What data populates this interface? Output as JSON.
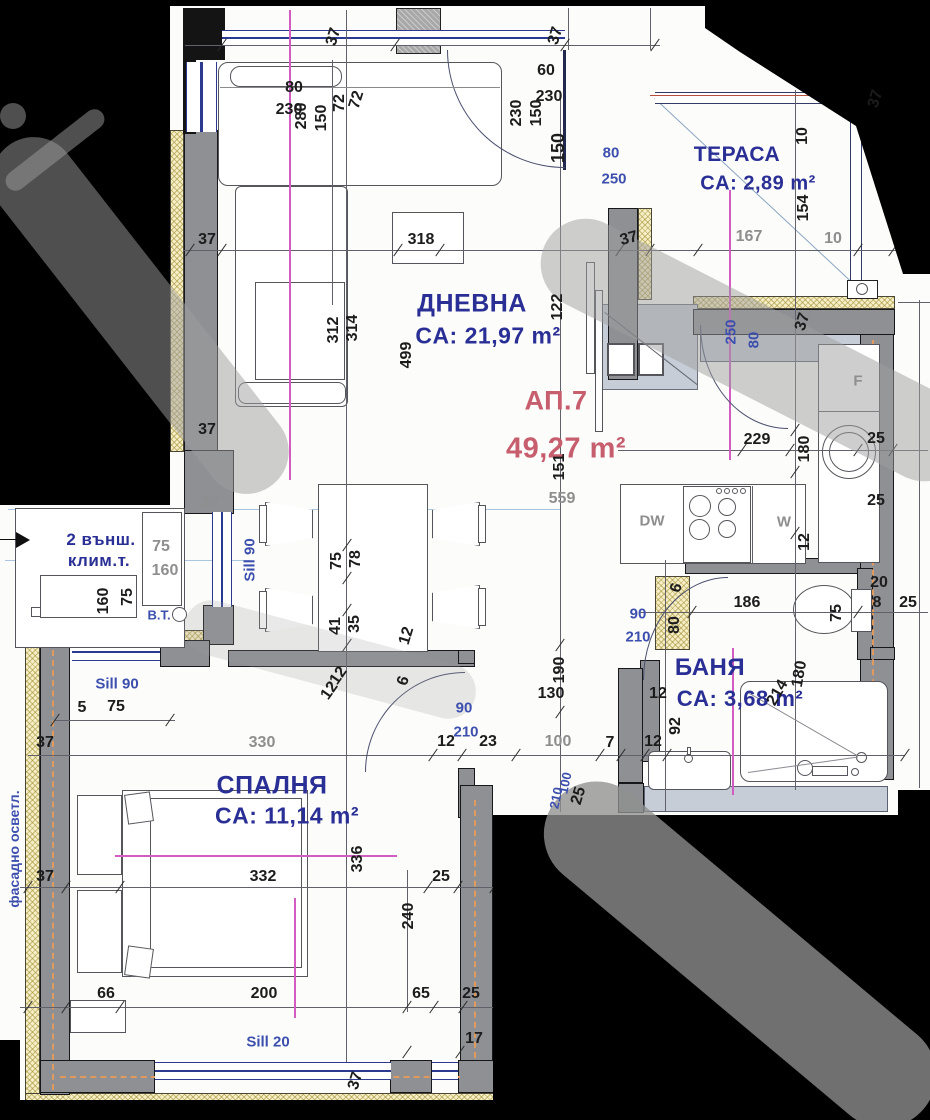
{
  "apartment": {
    "number": "АП.7",
    "area": "49,27 m²"
  },
  "rooms": {
    "living": {
      "name": "ДНЕВНА",
      "area": "CA: 21,97 m²"
    },
    "terrace": {
      "name": "ТЕРАСА",
      "area": "CA: 2,89 m²"
    },
    "bedroom": {
      "name": "СПАЛНЯ",
      "area": "CA: 11,14 m²"
    },
    "bath": {
      "name": "БАНЯ",
      "area": "CA: 3,68 m²"
    }
  },
  "notes": {
    "ac_line1": "2 външ.",
    "ac_line2": "клим.т.",
    "bt": "B.T.",
    "facade": "фасадно осветл.",
    "sill90_vert": "Sill 90",
    "sill90_horiz": "Sill 90",
    "sill20": "Sill 20"
  },
  "appliances": {
    "dishwasher": "DW",
    "washer": "W",
    "fridge": "F"
  },
  "colors": {
    "label_blue": "#2a2f96",
    "dim_dark": "#1c1c1c",
    "dim_gray": "#8e8e8e",
    "dim_blue": "#3c4fae",
    "apartment_red": "#c75e6e",
    "wall_gray": "#8e9094",
    "insulation_yellow": "#f6efc6",
    "centerline_magenta": "#d35cc2",
    "service_orange": "#e09a5e"
  },
  "dims": [
    {
      "t": "37",
      "x": 334,
      "y": 37,
      "r": -73
    },
    {
      "t": "37",
      "x": 556,
      "y": 36,
      "r": -73
    },
    {
      "t": "80",
      "x": 294,
      "y": 88
    },
    {
      "t": "230",
      "x": 289,
      "y": 110
    },
    {
      "t": "280",
      "x": 302,
      "y": 116,
      "r": -90
    },
    {
      "t": "150",
      "x": 322,
      "y": 118,
      "r": -90
    },
    {
      "t": "72",
      "x": 340,
      "y": 103,
      "r": -90
    },
    {
      "t": "72",
      "x": 357,
      "y": 100,
      "r": -73
    },
    {
      "t": "60",
      "x": 546,
      "y": 71
    },
    {
      "t": "230",
      "x": 549,
      "y": 97
    },
    {
      "t": "230",
      "x": 517,
      "y": 113,
      "r": -90
    },
    {
      "t": "150",
      "x": 537,
      "y": 113,
      "r": -90
    },
    {
      "t": "150",
      "x": 558,
      "y": 148,
      "r": -90,
      "fs": 18
    },
    {
      "t": "37",
      "x": 876,
      "y": 99,
      "r": -73
    },
    {
      "t": "10",
      "x": 803,
      "y": 136,
      "r": -90
    },
    {
      "t": "154",
      "x": 804,
      "y": 208,
      "r": -90
    },
    {
      "t": "80",
      "x": 611,
      "y": 153,
      "c": "b"
    },
    {
      "t": "250",
      "x": 614,
      "y": 179,
      "c": "b"
    },
    {
      "t": "167",
      "x": 749,
      "y": 237,
      "c": "g"
    },
    {
      "t": "10",
      "x": 833,
      "y": 239,
      "c": "g"
    },
    {
      "t": "37",
      "x": 629,
      "y": 239,
      "r": -15
    },
    {
      "t": "318",
      "x": 421,
      "y": 240
    },
    {
      "t": "37",
      "x": 207,
      "y": 240
    },
    {
      "t": "314",
      "x": 353,
      "y": 328,
      "r": -90
    },
    {
      "t": "312",
      "x": 334,
      "y": 330,
      "r": -90
    },
    {
      "t": "499",
      "x": 407,
      "y": 355,
      "r": -90
    },
    {
      "t": "122",
      "x": 558,
      "y": 307,
      "r": -90
    },
    {
      "t": "37",
      "x": 207,
      "y": 430
    },
    {
      "t": "37",
      "x": 803,
      "y": 322,
      "r": -73
    },
    {
      "t": "250",
      "x": 731,
      "y": 332,
      "r": -90,
      "c": "b"
    },
    {
      "t": "80",
      "x": 754,
      "y": 340,
      "r": -90,
      "c": "b"
    },
    {
      "t": "229",
      "x": 757,
      "y": 440
    },
    {
      "t": "180",
      "x": 805,
      "y": 449,
      "r": -90
    },
    {
      "t": "25",
      "x": 876,
      "y": 439
    },
    {
      "t": "25",
      "x": 876,
      "y": 501
    },
    {
      "t": "151",
      "x": 560,
      "y": 467,
      "r": -90
    },
    {
      "t": "559",
      "x": 562,
      "y": 499,
      "c": "g"
    },
    {
      "t": "12",
      "x": 805,
      "y": 542,
      "r": -90
    },
    {
      "t": "37",
      "x": 210,
      "y": 503,
      "c": "g"
    },
    {
      "t": "75",
      "x": 161,
      "y": 547,
      "c": "g"
    },
    {
      "t": "160",
      "x": 165,
      "y": 571,
      "c": "g"
    },
    {
      "t": "75",
      "x": 128,
      "y": 597,
      "r": -90
    },
    {
      "t": "160",
      "x": 104,
      "y": 601,
      "r": -90
    },
    {
      "t": "B.T.",
      "x": 159,
      "y": 615,
      "c": "b",
      "fs": 13
    },
    {
      "t": "Sill 90",
      "x": 250,
      "y": 560,
      "r": -90,
      "c": "b"
    },
    {
      "t": "78",
      "x": 356,
      "y": 559,
      "r": -90
    },
    {
      "t": "75",
      "x": 337,
      "y": 561,
      "r": -90
    },
    {
      "t": "35",
      "x": 355,
      "y": 624,
      "r": -90
    },
    {
      "t": "41",
      "x": 336,
      "y": 626,
      "r": -90
    },
    {
      "t": "12",
      "x": 407,
      "y": 636,
      "r": -73
    },
    {
      "t": "6",
      "x": 404,
      "y": 681,
      "r": -73
    },
    {
      "t": "12",
      "x": 339,
      "y": 676,
      "r": -55
    },
    {
      "t": "12",
      "x": 330,
      "y": 691,
      "r": -55
    },
    {
      "t": "20",
      "x": 879,
      "y": 583
    },
    {
      "t": "8",
      "x": 877,
      "y": 603
    },
    {
      "t": "25",
      "x": 908,
      "y": 603
    },
    {
      "t": "186",
      "x": 747,
      "y": 603
    },
    {
      "t": "75",
      "x": 837,
      "y": 613,
      "r": -90
    },
    {
      "t": "6",
      "x": 677,
      "y": 588,
      "r": -73
    },
    {
      "t": "80",
      "x": 675,
      "y": 625,
      "r": -90
    },
    {
      "t": "90",
      "x": 638,
      "y": 614,
      "c": "b"
    },
    {
      "t": "210",
      "x": 638,
      "y": 637,
      "c": "b"
    },
    {
      "t": "190",
      "x": 560,
      "y": 670,
      "r": -90
    },
    {
      "t": "130",
      "x": 551,
      "y": 694
    },
    {
      "t": "12",
      "x": 658,
      "y": 694
    },
    {
      "t": "180",
      "x": 800,
      "y": 674,
      "r": -80
    },
    {
      "t": "214",
      "x": 778,
      "y": 693,
      "r": -60
    },
    {
      "t": "92",
      "x": 676,
      "y": 726,
      "r": -90
    },
    {
      "t": "90",
      "x": 464,
      "y": 708,
      "c": "b"
    },
    {
      "t": "210",
      "x": 466,
      "y": 732,
      "c": "b"
    },
    {
      "t": "12",
      "x": 446,
      "y": 742
    },
    {
      "t": "23",
      "x": 488,
      "y": 742
    },
    {
      "t": "100",
      "x": 558,
      "y": 742,
      "c": "g"
    },
    {
      "t": "7",
      "x": 610,
      "y": 743
    },
    {
      "t": "12",
      "x": 653,
      "y": 742
    },
    {
      "t": "25",
      "x": 579,
      "y": 796,
      "r": -73
    },
    {
      "t": "100",
      "x": 565,
      "y": 783,
      "r": -78,
      "c": "b",
      "fs": 13
    },
    {
      "t": "210",
      "x": 556,
      "y": 798,
      "r": -78,
      "c": "b",
      "fs": 13
    },
    {
      "t": "Sill 90",
      "x": 117,
      "y": 684,
      "c": "b"
    },
    {
      "t": "5",
      "x": 82,
      "y": 708
    },
    {
      "t": "75",
      "x": 116,
      "y": 707
    },
    {
      "t": "37",
      "x": 45,
      "y": 743
    },
    {
      "t": "330",
      "x": 262,
      "y": 743,
      "c": "g"
    },
    {
      "t": "37",
      "x": 45,
      "y": 877
    },
    {
      "t": "332",
      "x": 263,
      "y": 877
    },
    {
      "t": "25",
      "x": 441,
      "y": 877
    },
    {
      "t": "336",
      "x": 358,
      "y": 859,
      "r": -90
    },
    {
      "t": "240",
      "x": 409,
      "y": 916,
      "r": -90
    },
    {
      "t": "66",
      "x": 106,
      "y": 994
    },
    {
      "t": "200",
      "x": 264,
      "y": 994
    },
    {
      "t": "65",
      "x": 421,
      "y": 994
    },
    {
      "t": "25",
      "x": 471,
      "y": 994
    },
    {
      "t": "17",
      "x": 474,
      "y": 1039
    },
    {
      "t": "Sill 20",
      "x": 268,
      "y": 1042,
      "c": "b"
    },
    {
      "t": "37",
      "x": 356,
      "y": 1081,
      "r": -73
    },
    {
      "t": "фасадно осветл.",
      "x": 14,
      "y": 849,
      "r": -90,
      "c": "b",
      "fs": 14
    },
    {
      "t": "DW",
      "x": 652,
      "y": 521,
      "c": "g",
      "fs": 15
    },
    {
      "t": "W",
      "x": 784,
      "y": 522,
      "c": "g",
      "fs": 15
    },
    {
      "t": "F",
      "x": 858,
      "y": 381,
      "c": "g",
      "fs": 15
    }
  ],
  "ticks": [
    [
      190,
      250
    ],
    [
      222,
      250
    ],
    [
      398,
      250
    ],
    [
      440,
      250
    ],
    [
      620,
      250
    ],
    [
      650,
      250
    ],
    [
      698,
      250
    ],
    [
      858,
      250
    ],
    [
      893,
      250
    ],
    [
      742,
      450
    ],
    [
      790,
      450
    ],
    [
      858,
      450
    ],
    [
      893,
      450
    ],
    [
      692,
      612
    ],
    [
      858,
      612
    ],
    [
      433,
      755
    ],
    [
      462,
      755
    ],
    [
      516,
      755
    ],
    [
      600,
      755
    ],
    [
      621,
      755
    ],
    [
      645,
      755
    ],
    [
      667,
      755
    ],
    [
      905,
      755
    ],
    [
      28,
      887
    ],
    [
      66,
      887
    ],
    [
      120,
      887
    ],
    [
      428,
      887
    ],
    [
      458,
      887
    ],
    [
      494,
      887
    ],
    [
      28,
      1007
    ],
    [
      66,
      1007
    ],
    [
      120,
      1007
    ],
    [
      407,
      1007
    ],
    [
      434,
      1007
    ],
    [
      463,
      1007
    ],
    [
      222,
      45
    ],
    [
      395,
      45
    ],
    [
      565,
      45
    ],
    [
      655,
      45
    ],
    [
      560,
      645
    ],
    [
      560,
      712
    ],
    [
      795,
      430
    ],
    [
      795,
      472
    ],
    [
      795,
      533
    ],
    [
      347,
      545
    ],
    [
      347,
      578
    ],
    [
      347,
      610
    ],
    [
      347,
      645
    ],
    [
      55,
      720
    ],
    [
      170,
      720
    ],
    [
      407,
      1052
    ],
    [
      460,
      1052
    ]
  ]
}
